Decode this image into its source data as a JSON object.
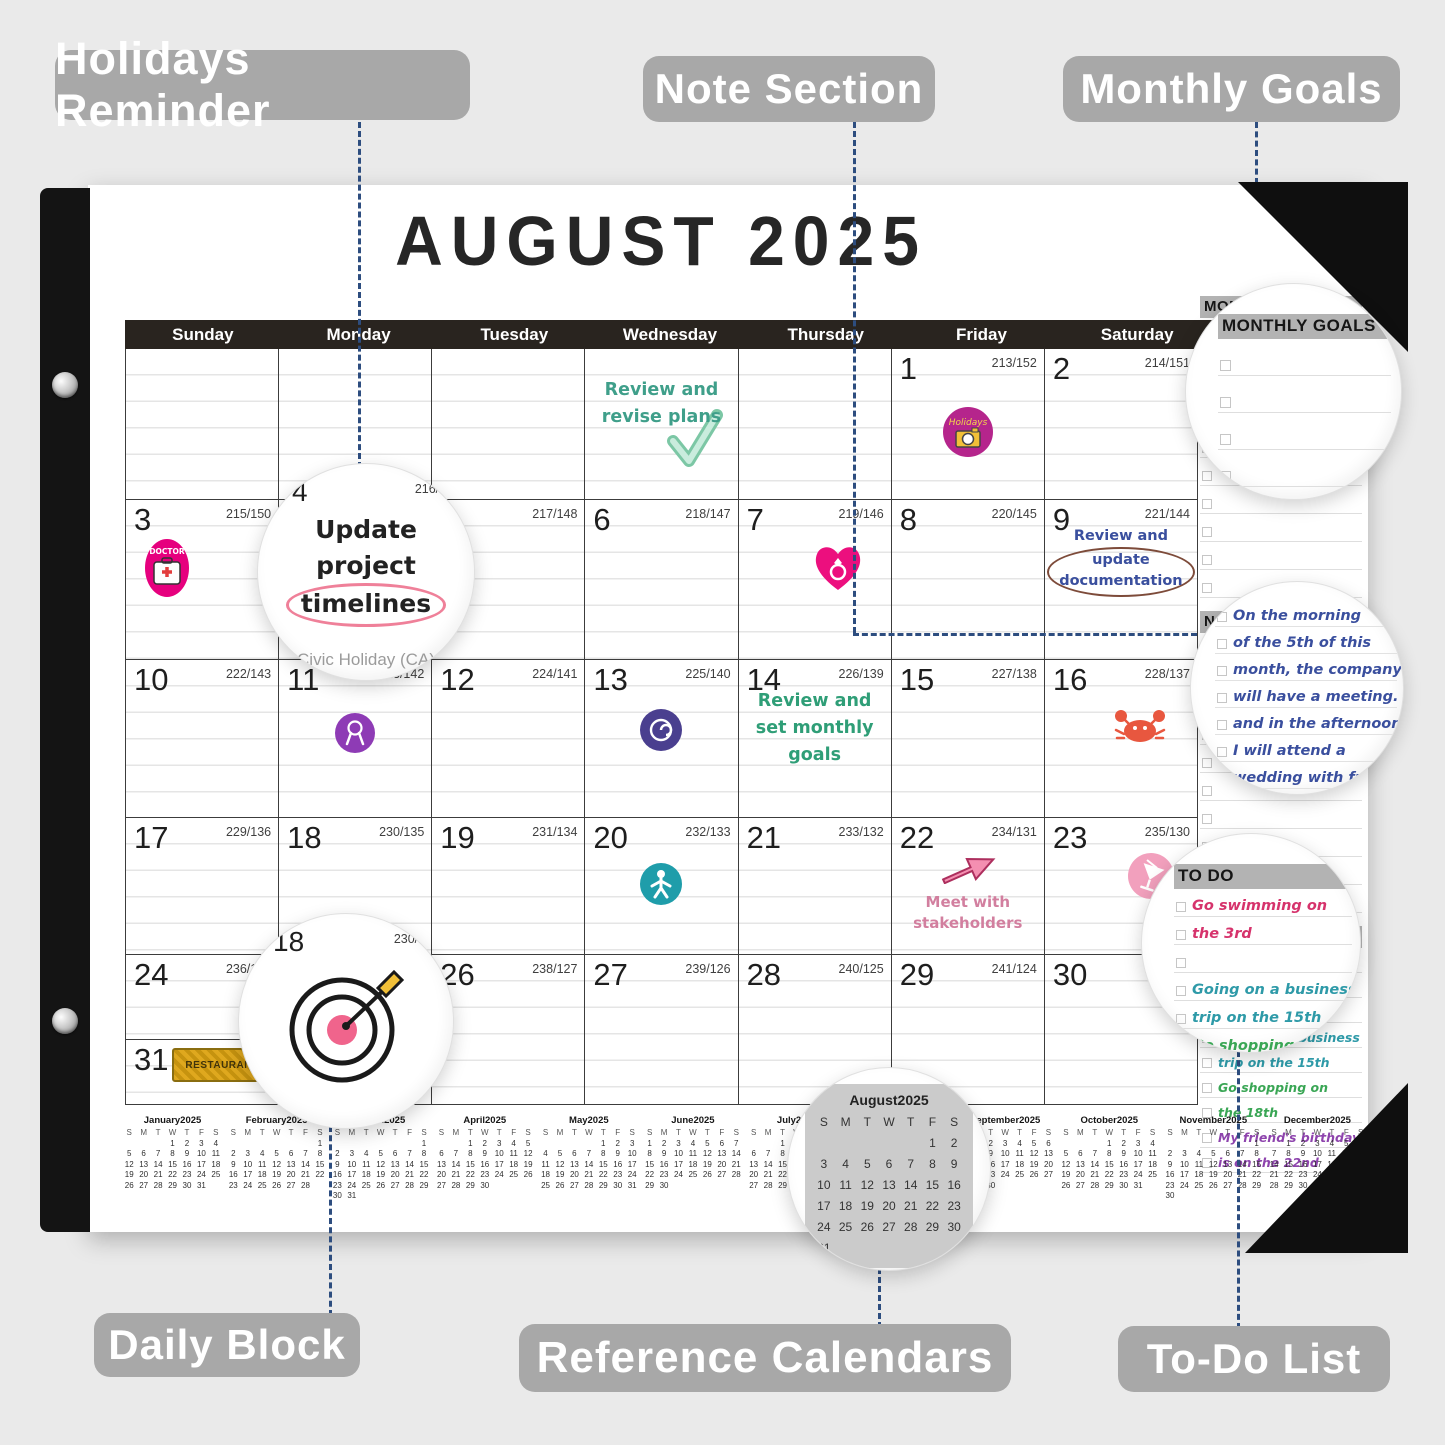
{
  "callouts": {
    "holidays_reminder": "Holidays Reminder",
    "note_section": "Note Section",
    "monthly_goals": "Monthly Goals",
    "daily_block": "Daily Block",
    "reference_calendars": "Reference Calendars",
    "todo_list": "To-Do List"
  },
  "page": {
    "title": "AUGUST 2025",
    "weekdays": [
      "Sunday",
      "Monday",
      "Tuesday",
      "Wednesday",
      "Thursday",
      "Friday",
      "Saturday"
    ]
  },
  "grid": {
    "weeks": [
      [
        {},
        {},
        {},
        {
          "note": "Review and revise plans",
          "note_color": "#3f9f8a",
          "icon": "check"
        },
        {},
        {
          "day": "1",
          "counter": "213/152",
          "sticker": "holidays-camera"
        },
        {
          "day": "2",
          "counter": "214/151"
        }
      ],
      [
        {
          "day": "3",
          "counter": "215/150",
          "sticker": "doctor"
        },
        {},
        {
          "day": "5",
          "counter": "217/148"
        },
        {
          "day": "6",
          "counter": "218/147"
        },
        {
          "day": "7",
          "counter": "219/146",
          "sticker": "heart-ring"
        },
        {
          "day": "8",
          "counter": "220/145"
        },
        {
          "day": "9",
          "counter": "221/144",
          "note": "Review and update documentation",
          "note_color": "#3a4f9e",
          "note_oval": true
        }
      ],
      [
        {
          "day": "10",
          "counter": "222/143"
        },
        {
          "day": "11",
          "counter": "223/142",
          "sticker": "purple-ribbon"
        },
        {
          "day": "12",
          "counter": "224/141"
        },
        {
          "day": "13",
          "counter": "225/140",
          "sticker": "purple-roll"
        },
        {
          "day": "14",
          "counter": "226/139",
          "note": "Review and set monthly goals",
          "note_color": "#2f9e77"
        },
        {
          "day": "15",
          "counter": "227/138"
        },
        {
          "day": "16",
          "counter": "228/137",
          "sticker": "crab"
        }
      ],
      [
        {
          "day": "17",
          "counter": "229/136"
        },
        {
          "day": "18",
          "counter": "230/135"
        },
        {
          "day": "19",
          "counter": "231/134"
        },
        {
          "day": "20",
          "counter": "232/133",
          "sticker": "teal-runner"
        },
        {
          "day": "21",
          "counter": "233/132"
        },
        {
          "day": "22",
          "counter": "234/131",
          "note": "Meet with stakeholders",
          "note_color": "#d27f9f",
          "sticker": "pink-arrow"
        },
        {
          "day": "23",
          "counter": "235/130",
          "sticker": "pink-drink"
        }
      ],
      [
        {
          "day": "24",
          "counter": "236/129"
        },
        {},
        {
          "day": "26",
          "counter": "238/127"
        },
        {
          "day": "27",
          "counter": "239/126"
        },
        {
          "day": "28",
          "counter": "240/125"
        },
        {
          "day": "29",
          "counter": "241/124"
        },
        {
          "day": "30",
          "counter": "242/123"
        }
      ]
    ],
    "overflow_cell": {
      "day": "31",
      "counter": "243/122",
      "sticker": "restaurant"
    }
  },
  "sticker_text": {
    "restaurant": "RESTAURANT",
    "holidays": "Holidays",
    "doctor": "DOCTOR"
  },
  "side_panel": {
    "monthly_goals": {
      "header": "MONTHLY GOALS",
      "rows": 10
    },
    "notes": {
      "header": "NOTES",
      "rows": 10,
      "ink_color": "#3a4f9e",
      "lines": [
        "On the morning",
        "of the 5th of this",
        "month, the company",
        "will have a meeting.",
        "and in the afternoon",
        "I will attend a",
        "wedding with friends"
      ]
    },
    "todo": {
      "header": "TO DO",
      "items": [
        {
          "lines": [
            "Go swimming on",
            "the 3rd"
          ],
          "color": "#d6336c"
        },
        {
          "lines": [
            "Going on a business",
            "trip on the 15th"
          ],
          "color": "#2e9aa8"
        },
        {
          "lines": [
            "Go shopping on",
            "the 18th"
          ],
          "color": "#3aa655"
        },
        {
          "lines": [
            "My friend's birthday",
            "is on the 22nd"
          ],
          "color": "#8e44ad"
        }
      ]
    }
  },
  "magnifiers": {
    "holiday_note": {
      "day": "4",
      "counter": "216/149",
      "lines": [
        "Update",
        "project",
        "timelines"
      ],
      "circled_word": "timelines",
      "circle_color": "#ef8099",
      "caption": "Civic Holiday (CA)"
    },
    "daily_block": {
      "day": "18",
      "counter": "230/135",
      "art": "dartboard"
    },
    "reference": {
      "month": "August2025"
    }
  },
  "mini_calendars": {
    "dow": [
      "S",
      "M",
      "T",
      "W",
      "T",
      "F",
      "S"
    ],
    "months": [
      {
        "name": "January2025",
        "first_dow": 3,
        "days": 31
      },
      {
        "name": "February2025",
        "first_dow": 6,
        "days": 28
      },
      {
        "name": "March2025",
        "first_dow": 6,
        "days": 31
      },
      {
        "name": "April2025",
        "first_dow": 2,
        "days": 30
      },
      {
        "name": "May2025",
        "first_dow": 4,
        "days": 31
      },
      {
        "name": "June2025",
        "first_dow": 0,
        "days": 30
      },
      {
        "name": "July2025",
        "first_dow": 2,
        "days": 31
      },
      {
        "name": "August2025",
        "first_dow": 5,
        "days": 31
      },
      {
        "name": "September2025",
        "first_dow": 1,
        "days": 30
      },
      {
        "name": "October2025",
        "first_dow": 3,
        "days": 31
      },
      {
        "name": "November2025",
        "first_dow": 6,
        "days": 30
      },
      {
        "name": "December2025",
        "first_dow": 1,
        "days": 31
      }
    ]
  },
  "colors": {
    "background": "#eaeaea",
    "callout_bg": "#a8a8a8",
    "weekday_bar": "#29241f",
    "dashed_line": "#2d4d7f",
    "panel_header_bg": "#b3b3b3",
    "notes_ink": "#3a4f9e",
    "teal_note": "#3f9f8a",
    "green_note": "#2f9e77",
    "pink_note": "#d27f9f"
  }
}
